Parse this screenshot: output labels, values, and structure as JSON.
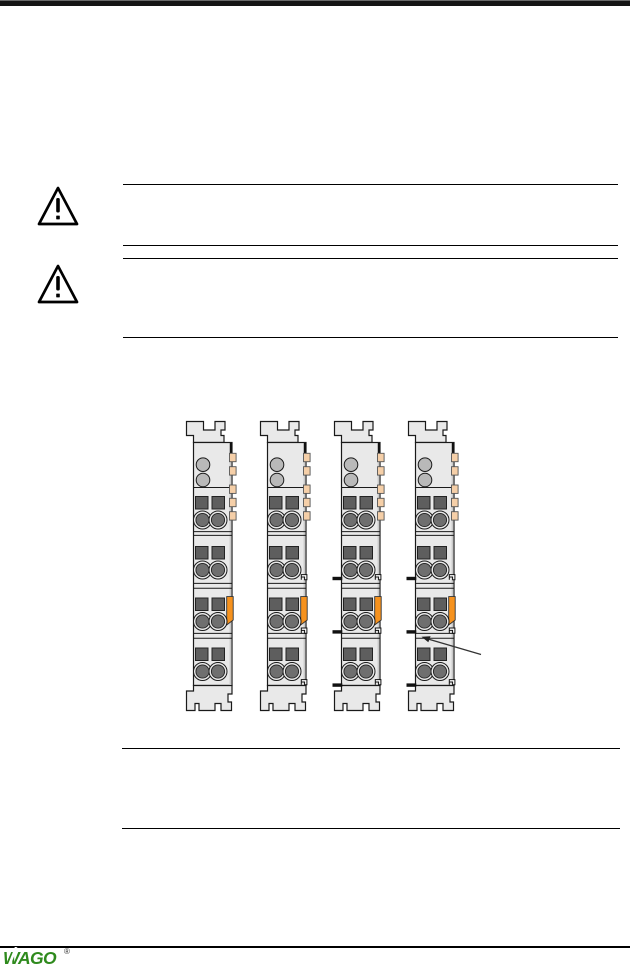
{
  "page": {
    "top_bar_color": "#151515",
    "background": "#ffffff",
    "rule_color": "#000000"
  },
  "warnings": [
    {
      "icon": "warning-triangle"
    },
    {
      "icon": "warning-triangle"
    }
  ],
  "figure": {
    "modules": [
      {
        "name": "terminal-module-1",
        "left_tabs": false,
        "right_hooks": false
      },
      {
        "name": "terminal-module-2",
        "left_tabs": false,
        "right_hooks": true
      },
      {
        "name": "terminal-module-3",
        "left_tabs": true,
        "right_hooks": true
      },
      {
        "name": "terminal-module-4",
        "left_tabs": true,
        "right_hooks": true
      }
    ],
    "pointer_arrow": {
      "target": "left-tab-of-module-4"
    },
    "colors": {
      "body": "#e9e9e9",
      "clamp_square": "#5e5e5e",
      "clamp_circle": "#6f6f6f",
      "clamp_ring": "#e9e9e9",
      "led": "#b9b9b9",
      "side_tab": "#f5cfa8",
      "latch_orange": "#f6921e"
    }
  },
  "footer": {
    "logo_text": "WAGO",
    "registered_mark": "®",
    "logo_color": "#2f8a1d"
  }
}
